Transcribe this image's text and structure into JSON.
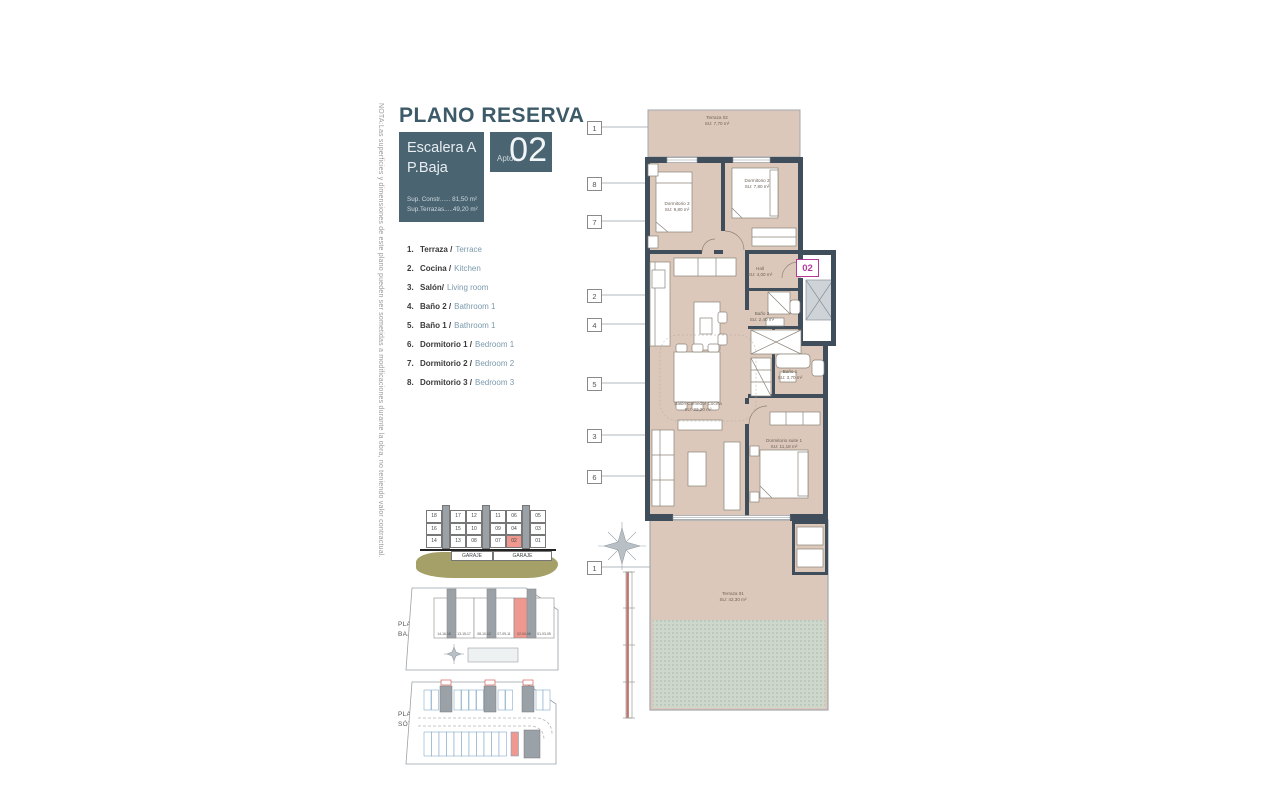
{
  "note": "NOTA:Las superficies y dimensiones de este plano pueden ser sometidas a modificaciones durante la obra, no teniendo valor contractual.",
  "header": {
    "title": "PLANO RESERVA",
    "escalera": "Escalera A",
    "planta": "P.Baja",
    "sup_constr": "Sup. Constr...... 81,50 m²",
    "sup_terrazas": "Sup.Terrazas.....49,20 m²",
    "apto_prefix": "Apto.",
    "apto_number": "02"
  },
  "legend": {
    "items": [
      {
        "num": "1.",
        "es": "Terraza /",
        "en": "Terrace"
      },
      {
        "num": "2.",
        "es": "Cocina /",
        "en": "Kitchen"
      },
      {
        "num": "3.",
        "es": "Salón/",
        "en": "Living room"
      },
      {
        "num": "4.",
        "es": "Baño 2 /",
        "en": "Bathroom 1"
      },
      {
        "num": "5.",
        "es": "Baño 1 /",
        "en": "Bathroom 1"
      },
      {
        "num": "6.",
        "es": "Dormitorio 1 /",
        "en": "Bedroom 1"
      },
      {
        "num": "7.",
        "es": "Dormitorio 2 /",
        "en": "Bedroom 2"
      },
      {
        "num": "8.",
        "es": "Dormitorio 3 /",
        "en": "Bedroom 3"
      }
    ]
  },
  "badge": "02",
  "plan": {
    "callouts": [
      "1",
      "8",
      "7",
      "2",
      "4",
      "5",
      "3",
      "6",
      "1"
    ],
    "rooms": {
      "terraza02": {
        "name": "Terraza 02",
        "area": "SU: 7,70 m²"
      },
      "dorm3": {
        "name": "Dormitorio 3",
        "area": "SU: 9,80 m²"
      },
      "dorm2": {
        "name": "Dormitorio 2",
        "area": "SU: 7,80 m²"
      },
      "hall": {
        "name": "Hall",
        "area": "SU: 4,00 m²"
      },
      "bano2": {
        "name": "Baño 2",
        "area": "SU: 2,40 m²"
      },
      "bano1": {
        "name": "Baño 1",
        "area": "SU: 3,70 m²"
      },
      "salon": {
        "name": "Salón Comedor Cocina",
        "area": "SU: 22,20 m²"
      },
      "suite": {
        "name": "Dormitorio suite 1",
        "area": "SU: 11,18 m²"
      },
      "terraza01": {
        "name": "Terraza 01",
        "area": "SU: 42,30 m²"
      }
    }
  },
  "site_elevation": {
    "columns": [
      [
        "18",
        "16",
        "14"
      ],
      [
        "17",
        "15",
        "13"
      ],
      [
        "12",
        "10",
        "08"
      ],
      [
        "11",
        "09",
        "07"
      ],
      [
        "06",
        "04",
        "02"
      ],
      [
        "05",
        "03",
        "01"
      ]
    ],
    "highlight": "02",
    "garaje_labels": [
      "GARAJE",
      "GARAJE"
    ]
  },
  "planta_baja": {
    "label_line1": "PLANTA",
    "label_line2": "BAJA",
    "blocks": [
      "14-16-18",
      "13-15-17",
      "08-10-12",
      "07-09-11",
      "02-04-06",
      "01-03-05"
    ]
  },
  "planta_sotano": {
    "label_line1": "PLANTA",
    "label_line2": "SÓTANO"
  },
  "colors": {
    "teal": "#4a6472",
    "magenta": "#b5399b",
    "highlight_red": "#ee988f",
    "wall": "#3f4e5a",
    "floor": "#dcc8ba"
  }
}
